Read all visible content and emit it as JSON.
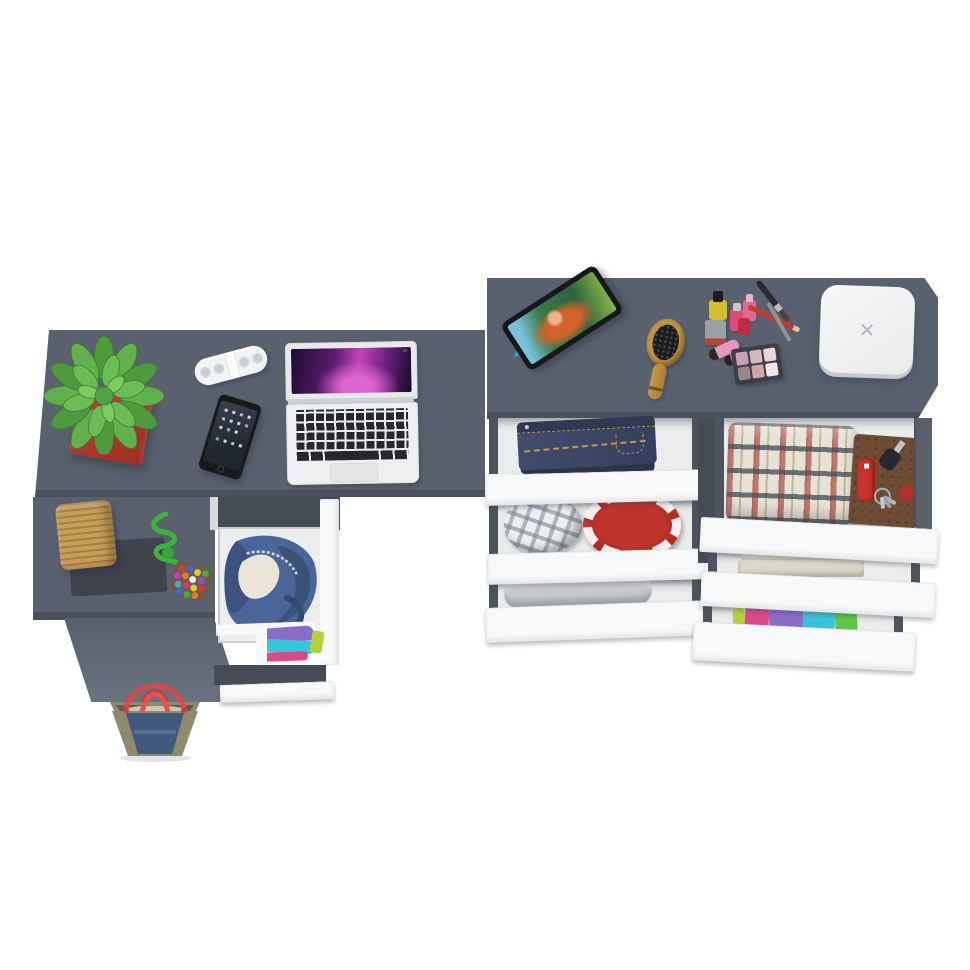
{
  "scene": {
    "type": "3d-furniture-product-render-top-view",
    "background": "#ffffff",
    "description": "Grey L-shaped desk with laptop, plant, speaker and phone; matching grey dresser with six open white drawers holding jeans, plaid shirts, linens and colorful t-shirts; makeup, tablet, hairbrush and a white box on the dresser top; denim tote bag on the floor"
  },
  "white_box": {
    "logo_glyph": "✕"
  },
  "colors": {
    "desk": "#5a616e",
    "desk_edge": "#4b515c",
    "frame": "#464c56",
    "rail": "#4e545e",
    "front": "#f8f9fa",
    "interior": "#ebecec",
    "pot_red": "#b03a30",
    "leaf_green": "#55a043",
    "rope_green": "#3cb43c",
    "basket_tan": "#c79e5e",
    "mat_dark": "#3e434c",
    "denim_tote": "#42597e",
    "khaki": "#8f8a6e",
    "handle_red": "#d84a4a",
    "bag_denim": "#4a659a",
    "jeans": "#3b4463",
    "stitch_gold": "#c9a45a",
    "red_round": "#b8302a",
    "plaid_red": "#b2554a",
    "plaid_gray": "#4a5058",
    "linen": "#dcd8cb",
    "gray_fabric": "#c8cacd",
    "notebook_brown": "#6e4c33",
    "knife_red": "#c8352c",
    "wood": "#c79b4e",
    "tablet_stand": "#35a3d6",
    "screen_pink": "#c247b8",
    "box_white": "#f4f5f6",
    "pan1": "#c8a2ae",
    "pan2": "#d7b6c0",
    "pan3": "#e9d6db",
    "pan4": "#98898b",
    "pan5": "#d2a4ac",
    "pan6": "#f0e6e8",
    "tee1": "#b6cf3a",
    "tee2": "#d84a8a",
    "tee3": "#8a6cc8",
    "tee4": "#3ac4d8",
    "tee5": "#5fc84a"
  },
  "objects": {
    "left_desk": [
      "potted-plant",
      "portable-speaker",
      "smartphone",
      "laptop",
      "wicker-basket",
      "bead-pouch-rope-toy",
      "open-drawer-denim-bag",
      "open-drawer-folded-clothes",
      "denim-tote-bag"
    ],
    "right_dresser_top": [
      "tablet-on-stand",
      "wooden-hairbrush",
      "nail-polish-set",
      "lipsticks",
      "makeup-brushes",
      "eyeshadow-palette",
      "white-square-box"
    ],
    "right_dresser_drawers": [
      "folded-jeans",
      "plaid-cap-and-red-round-box",
      "gray-folded-sweater",
      "plaid-shirt-notebook-knife-keys",
      "white-linens",
      "colorful-folded-t-shirts"
    ]
  }
}
